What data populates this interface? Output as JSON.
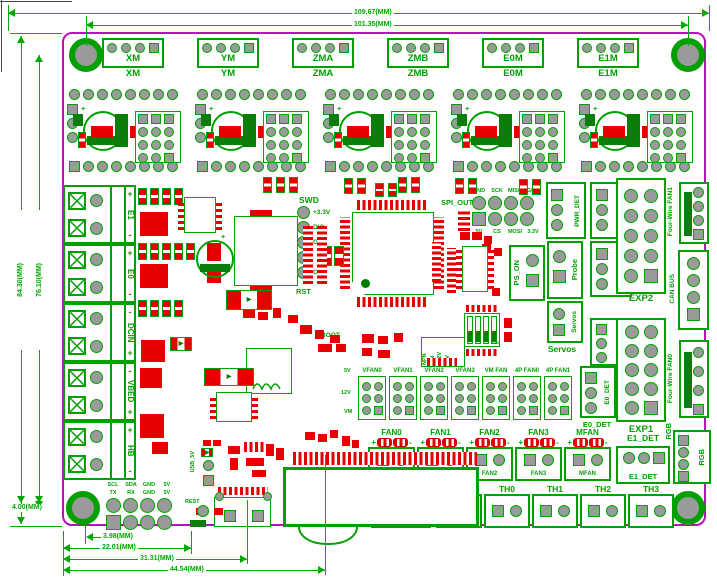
{
  "board": {
    "outline_color": "#b713b7",
    "silk_color": "#00a000",
    "pad_red": "#e60000",
    "hole_gray": "#9a9a9a"
  },
  "dimensions": {
    "top_outer": "109.67(MM)",
    "top_inner": "101.35(MM)",
    "left_outer": "84.30(MM)",
    "left_inner": "76.10(MM)",
    "left_bottom": "4.00(MM)",
    "bottom": [
      "3.98(MM)",
      "22.01(MM)",
      "31.31(MM)",
      "44.54(MM)"
    ]
  },
  "motors": [
    "XM",
    "YM",
    "ZMA",
    "ZMB",
    "E0M",
    "E1M"
  ],
  "terminals": [
    {
      "sign_top": "+",
      "name": "E1",
      "sign_bottom": "-"
    },
    {
      "sign_top": "+",
      "name": "E0",
      "sign_bottom": "-"
    },
    {
      "sign_top": "-",
      "name": "DCIN",
      "sign_bottom": "+"
    },
    {
      "sign_top": "-",
      "name": "VBED",
      "sign_bottom": "+"
    },
    {
      "sign_top": "+",
      "name": "HB",
      "sign_bottom": "-"
    }
  ],
  "swd": {
    "title": "SWD",
    "pins": [
      "+3.3V",
      "DIO",
      "GND",
      "",
      "CLK"
    ],
    "reset": "RST"
  },
  "spi_out": {
    "title": "SPI_OUT",
    "top_row": [
      "GND",
      "SCK",
      "MISO",
      "GND"
    ],
    "bottom_row": [
      "5V",
      "CS",
      "MOSI",
      "3.3V"
    ]
  },
  "right": {
    "pwr_det": "PWR_DET",
    "x_stop": "X-STOP",
    "y_stop": "Y-STOP",
    "z_stop": "Z-STOP",
    "ps_on": "PS_ON",
    "probe": "Probe",
    "servos": "Servos",
    "servos_h": "Servos",
    "e0_det": "E0_DET",
    "e0_det_h": "E0_DET",
    "exp2": "EXP2",
    "exp1": "EXP1",
    "fourwire_fan1": "Four-Wire FAN1",
    "fourwire_fan0": "Four-Wire FAN0",
    "can_bus": "CAN BUS",
    "rgb": "RGB",
    "rgb_inner": "RGB",
    "e1_det": "E1_DET",
    "e1_det_inner": "E1_DET"
  },
  "jumpers": {
    "labels": [
      "VFAN0",
      "VFAN1",
      "VFAN2",
      "VFAN3",
      "VM FAN",
      "4P FAN0",
      "4P FAN1"
    ],
    "row_marks": [
      "5V",
      "12V",
      "VM"
    ]
  },
  "fans": {
    "items": [
      "FAN0",
      "FAN1",
      "FAN2",
      "FAN3",
      "MFAN"
    ],
    "plus": "+",
    "minus": "-"
  },
  "sensors": {
    "proximity": "Proximity",
    "thermistors": [
      "THB",
      "TH0",
      "TH1",
      "TH2",
      "TH3"
    ]
  },
  "bottom_header": {
    "row1": [
      "SCL",
      "SDA",
      "GND",
      "5V"
    ],
    "row2": [
      "TX",
      "RX",
      "GND",
      "5V"
    ]
  },
  "misc": {
    "boot": "BOOT",
    "usb_5v": "USB_5V",
    "reset": "REST",
    "dip_on": "ON",
    "power_pins": [
      "NPN",
      "VIN",
      "+12V",
      "+5V"
    ],
    "cap_plus": "+"
  }
}
